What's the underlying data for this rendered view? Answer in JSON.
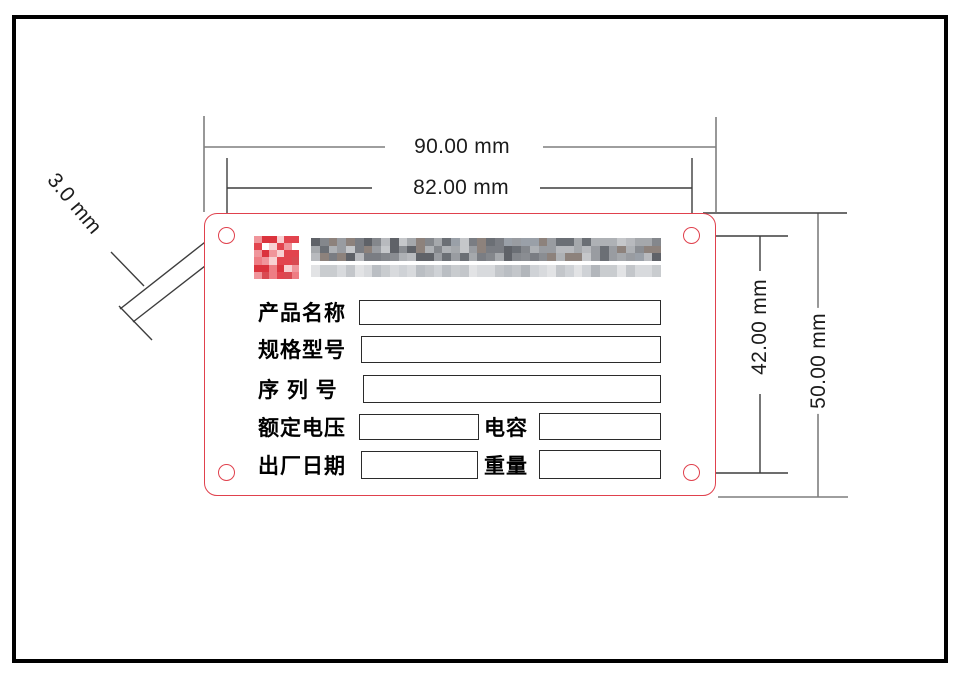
{
  "dimensions": {
    "plate_width": "90.00 mm",
    "hole_spacing_x": "82.00 mm",
    "hole_spacing_y": "42.00 mm",
    "plate_height": "50.00 mm",
    "hole_diameter": "3.0 mm"
  },
  "plate": {
    "company_header": {
      "logo": "pixelated-red-logo",
      "name_line1": "pixelated-company-name",
      "name_line2": "pixelated-company-subtitle"
    },
    "rows": [
      {
        "label": "产品名称"
      },
      {
        "label": "规格型号"
      },
      {
        "label": "序 列 号"
      },
      {
        "label": "额定电压",
        "label2": "电容"
      },
      {
        "label": "出厂日期",
        "label2": "重量"
      }
    ]
  },
  "colors": {
    "plate_outline": "#e0414d",
    "dimension_line_gray": "#7f7f7f",
    "dimension_line_dark": "#3d3d3d",
    "dimension_text": "#1c1c1c",
    "field_text": "#000000"
  },
  "mosaic": {
    "logo_palette": [
      "#e2444e",
      "#e95b63",
      "#f0959b",
      "#f8d0d2",
      "#db333d",
      "#ffffff",
      "#ee7d84",
      "#e2444e",
      "#d94a52"
    ],
    "name_dark_palette": [
      "#6b6f75",
      "#8a8d92",
      "#a5a8ac",
      "#7a7d83",
      "#999ca1",
      "#b8babe",
      "#5f6268",
      "#9aa0a8",
      "#84878c",
      "#aeb1b5",
      "#8d827c",
      "#c5c7ca"
    ],
    "name_light_palette": [
      "#c3c6ca",
      "#cfd2d6",
      "#babec3",
      "#d8dadd",
      "#c9cccf",
      "#e2e3e5",
      "#b2b6bb"
    ]
  }
}
